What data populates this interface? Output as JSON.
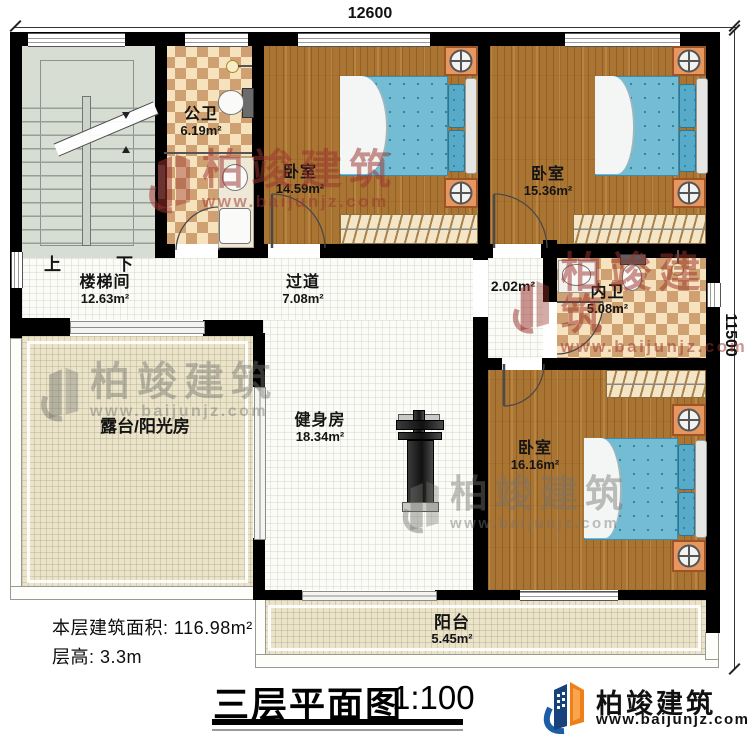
{
  "dimensions": {
    "width_mm": "12600",
    "height_mm": "11500"
  },
  "rooms": {
    "stairwell": {
      "label": "楼梯间",
      "area": "12.63m²"
    },
    "public_bath": {
      "label": "公卫",
      "area": "6.19m²"
    },
    "bedroom1": {
      "label": "卧室",
      "area": "14.59m²"
    },
    "bedroom2": {
      "label": "卧室",
      "area": "15.36m²"
    },
    "hallway": {
      "label": "过道",
      "area": "7.08m²"
    },
    "vestibule": {
      "area": "2.02m²"
    },
    "ensuite_bath": {
      "label": "内卫",
      "area": "5.08m²"
    },
    "terrace": {
      "label": "露台/阳光房"
    },
    "gym": {
      "label": "健身房",
      "area": "18.34m²"
    },
    "bedroom3": {
      "label": "卧室",
      "area": "16.16m²"
    },
    "balcony": {
      "label": "阳台",
      "area": "5.45m²"
    }
  },
  "stairs": {
    "up": "上",
    "down": "下"
  },
  "notes": {
    "floor_area": "本层建筑面积: 116.98m²",
    "floor_height": "层高: 3.3m"
  },
  "title_block": {
    "title": "三层平面图",
    "scale": "1:100"
  },
  "branding": {
    "name": "柏竣建筑",
    "website": "www.baijunjz.com"
  },
  "watermark": {
    "name": "柏竣建筑",
    "website": "www.baijunjz.com"
  },
  "icons": {
    "toilet": "toilet-icon",
    "sink": "sink-icon",
    "shower": "shower-icon",
    "washer": "washer-icon",
    "bed": "bed",
    "nightstand_lamp": "lamp-icon",
    "wardrobe": "wardrobe",
    "stairs": "stairs",
    "gym_bench": "gym-bench-icon",
    "logo_building": "building-logo-icon"
  },
  "colors": {
    "wall": "#000000",
    "wood_floor": "#aa7433",
    "checker_light": "#f6e2bc",
    "checker_dark": "#cfa172",
    "tile": "#fbfbf8",
    "stair": "#d7ddd3",
    "terrace": "#ebe4cb",
    "mattress": "#74bcd4",
    "pillow": "#58abc8",
    "nightstand": "#e6975f",
    "watermark_red": "#9b342e",
    "watermark_gray": "#73736e",
    "logo_blue": "#1b5ea6",
    "logo_orange": "#ef7f1b"
  }
}
